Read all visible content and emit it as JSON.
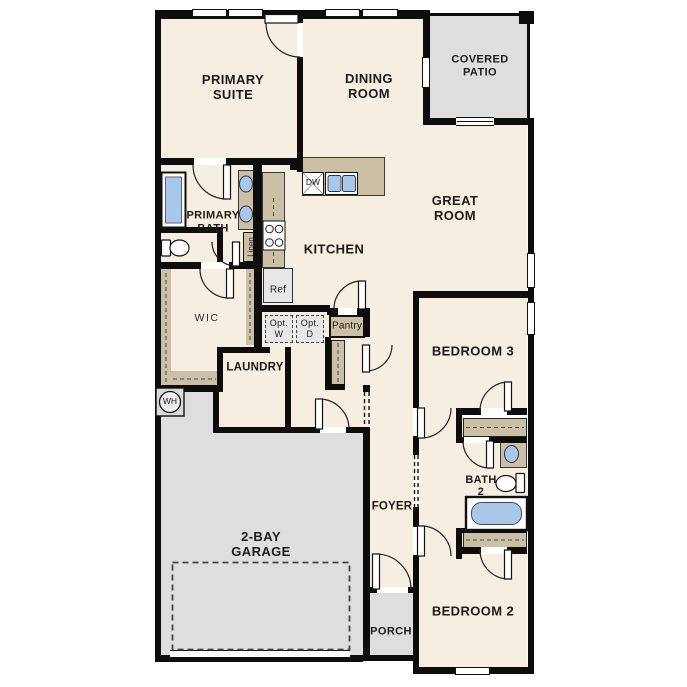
{
  "title": "Single-story floor plan",
  "labels": {
    "primary_suite": [
      "PRIMARY",
      "SUITE"
    ],
    "dining": [
      "DINING",
      "ROOM"
    ],
    "covered_patio": [
      "COVERED",
      "PATIO"
    ],
    "great_room": [
      "GREAT",
      "ROOM"
    ],
    "kitchen": "KITCHEN",
    "primary_bath": [
      "PRIMARY",
      "BATH"
    ],
    "wic": "WIC",
    "linen": "Linen",
    "laundry": "LAUNDRY",
    "dw": "DW",
    "ref": "Ref",
    "opt_w": [
      "Opt.",
      "W"
    ],
    "opt_d": [
      "Opt.",
      "D"
    ],
    "pantry": "Pantry",
    "wh": "WH",
    "bedroom3": "BEDROOM 3",
    "bath2": [
      "BATH",
      "2"
    ],
    "foyer": "FOYER",
    "garage": [
      "2-BAY",
      "GARAGE"
    ],
    "porch": "PORCH",
    "bedroom2": "BEDROOM 2"
  },
  "colors": {
    "floor_cream": "#f6eee1",
    "outdoor_gray": "#dfdede",
    "casework_tan": "#cbbfa5",
    "fixture_blue": "#a9c8e9",
    "wall_black": "#0d0d0d",
    "appliance_box_gray": "#e7e7e7"
  }
}
